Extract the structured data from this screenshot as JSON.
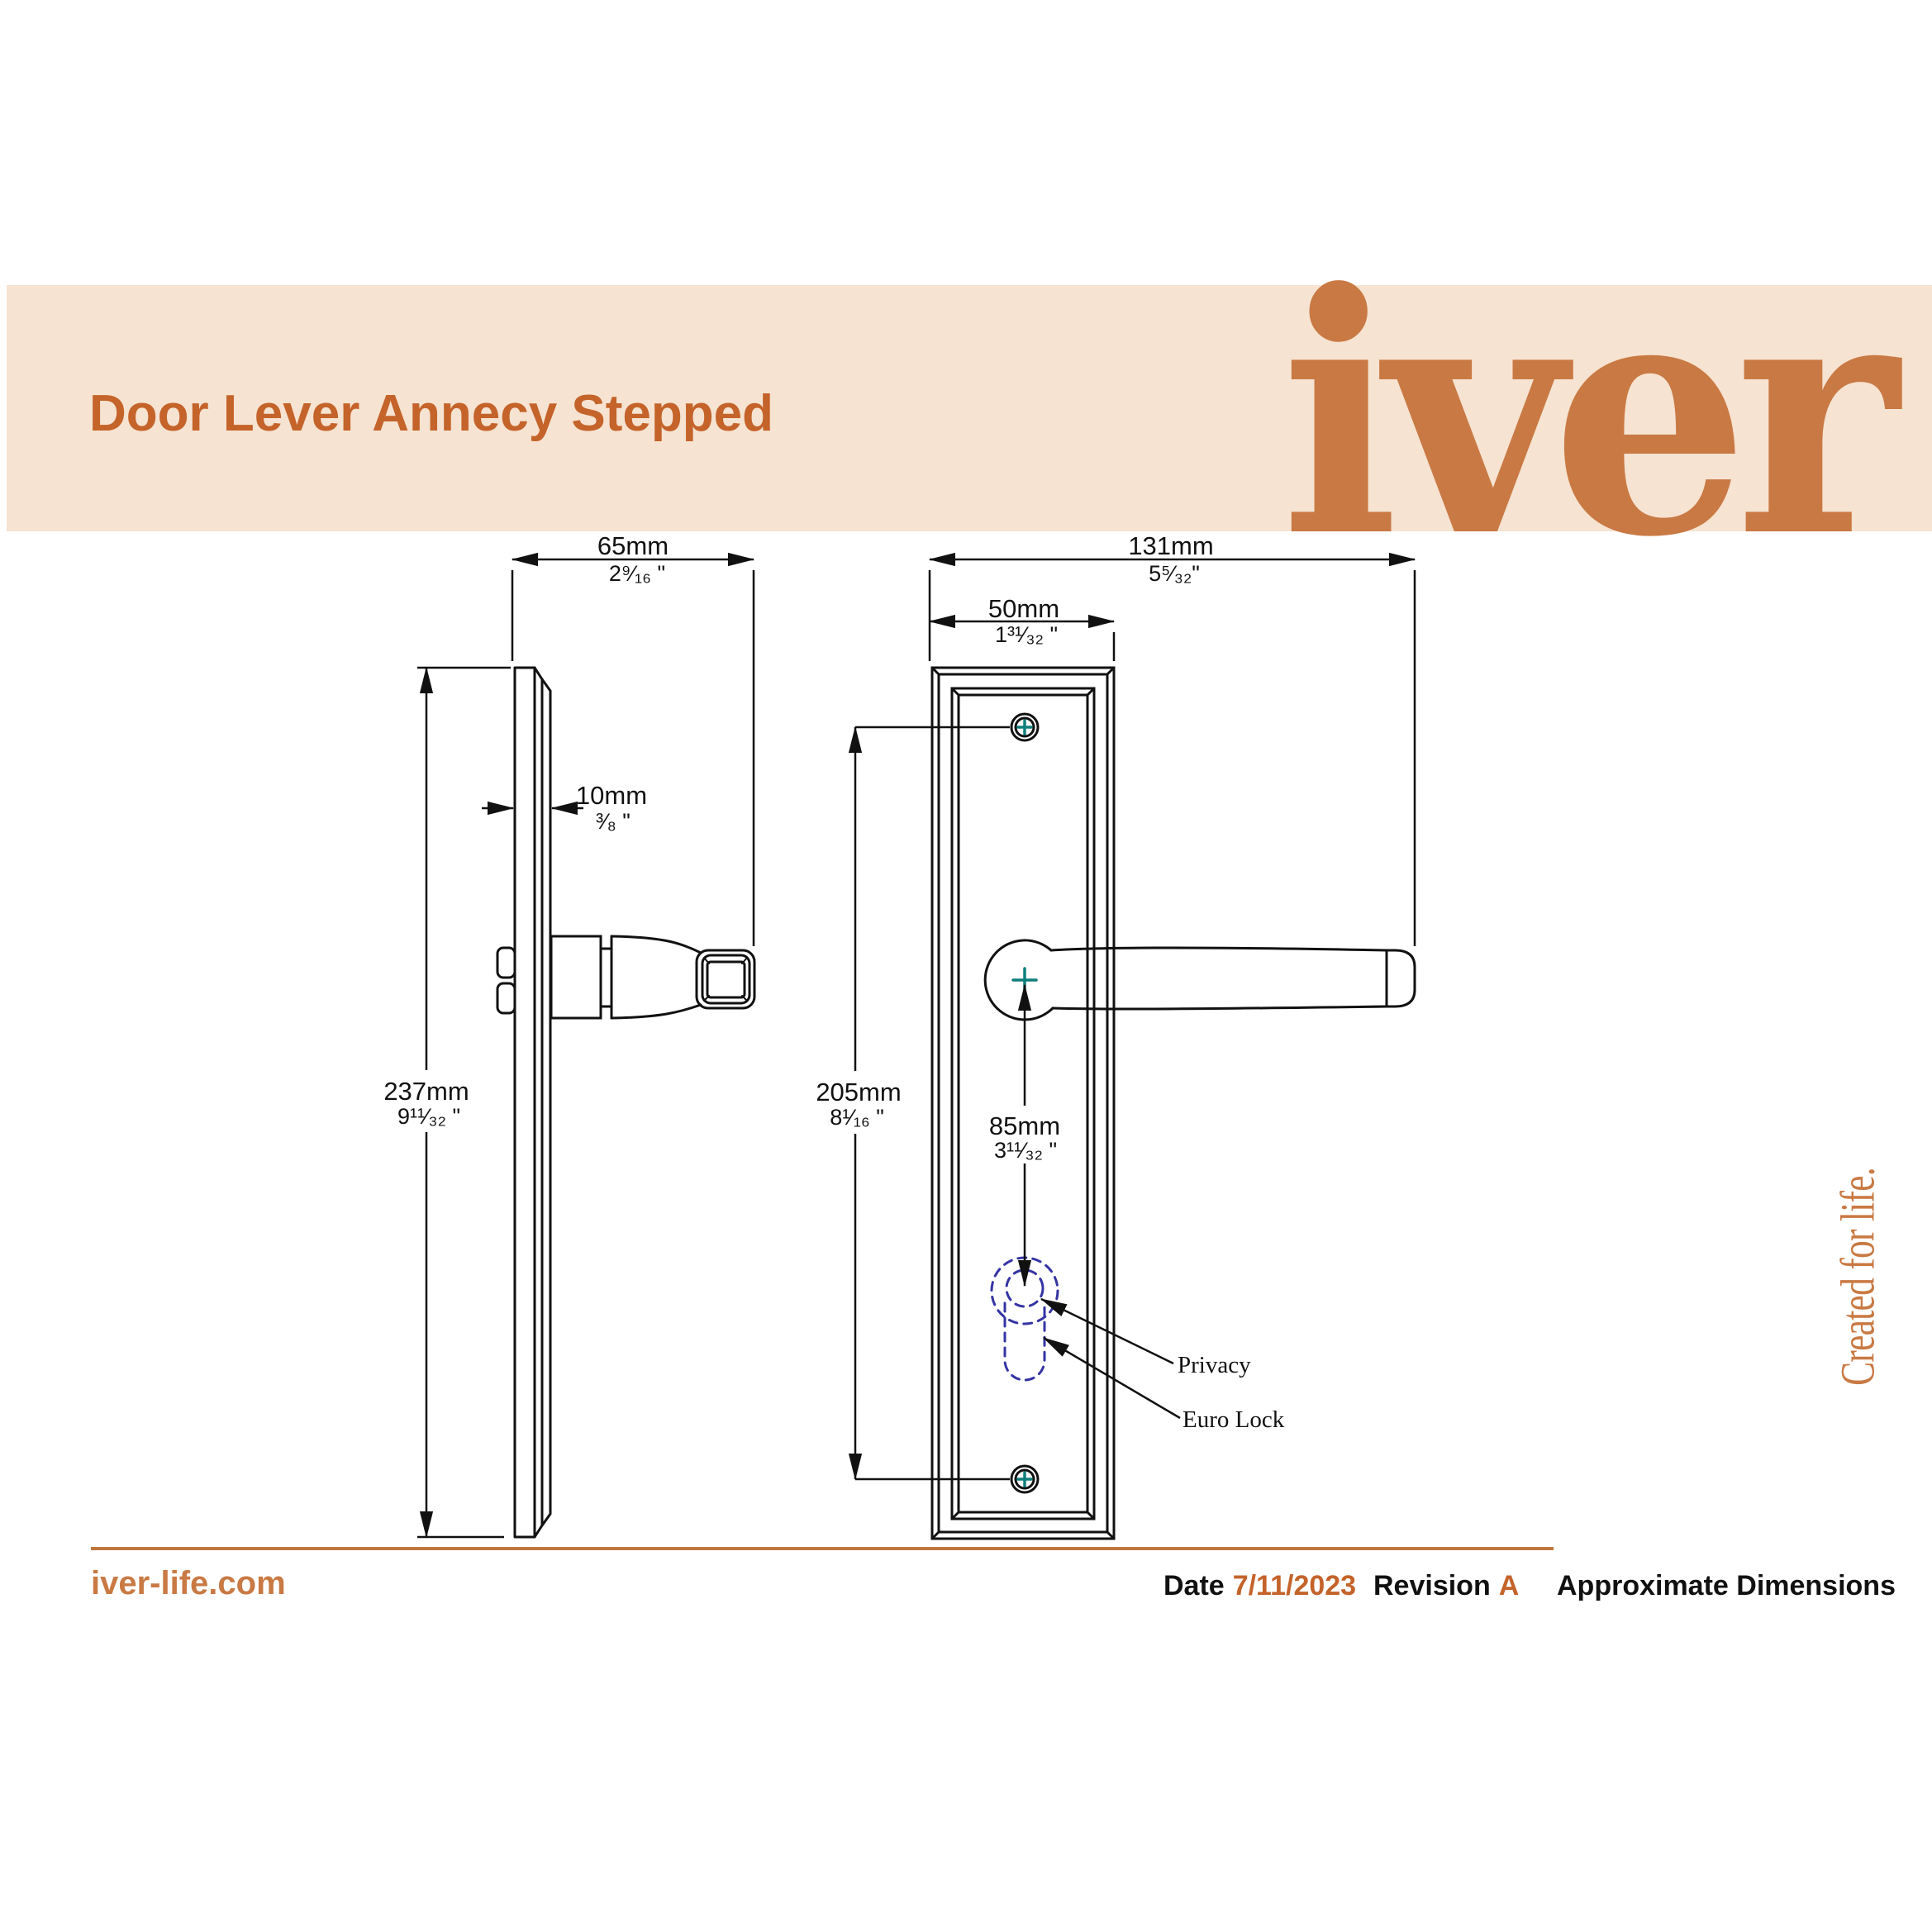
{
  "header": {
    "title": "Door Lever Annecy Stepped",
    "brand": "iver",
    "tagline": "Created for life."
  },
  "dimensions": {
    "side_projection": {
      "mm": "65mm",
      "in": "2⁹⁄₁₆ \""
    },
    "plate_thickness": {
      "mm": "10mm",
      "in": "³⁄₈ \""
    },
    "plate_height": {
      "mm": "237mm",
      "in": "9¹¹⁄₃₂ \""
    },
    "overall_width": {
      "mm": "131mm",
      "in": "5⁵⁄₃₂\""
    },
    "plate_width": {
      "mm": "50mm",
      "in": "1³¹⁄₃₂ \""
    },
    "screw_centres": {
      "mm": "205mm",
      "in": "8¹⁄₁₆ \""
    },
    "lever_to_key": {
      "mm": "85mm",
      "in": "3¹¹⁄₃₂ \""
    }
  },
  "annotations": {
    "privacy": "Privacy",
    "euro_lock": "Euro Lock"
  },
  "footer": {
    "website": "iver-life.com",
    "date_label": "Date",
    "date_value": "7/11/2023",
    "revision_label": "Revision",
    "revision_value": "A",
    "note": "Approximate Dimensions"
  },
  "colors": {
    "accent_orange": "#c4632a",
    "logo_orange": "#c97943",
    "banner_background": "#f6e3d1",
    "line_black": "#111111",
    "screw_cross_teal": "#0e7f7b",
    "keyhole_dashed_blue": "#3434a4"
  }
}
